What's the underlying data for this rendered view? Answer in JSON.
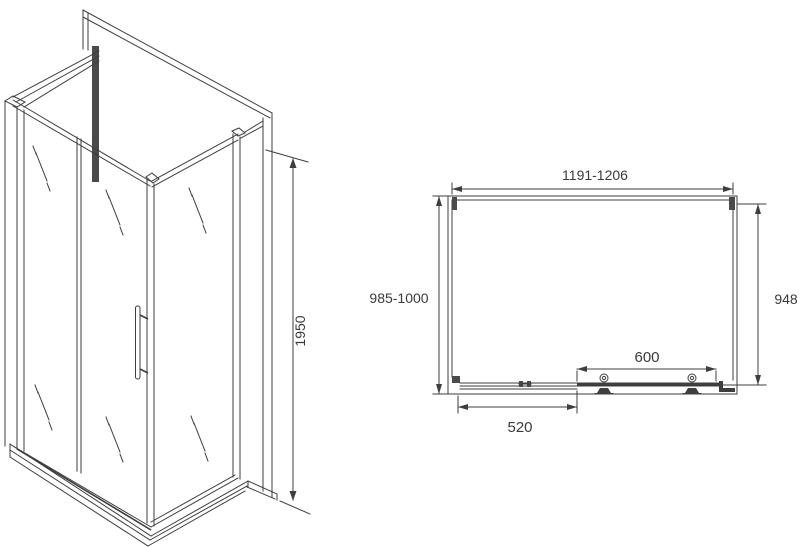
{
  "colors": {
    "line": "#3e3e3e",
    "text": "#3a3a3a",
    "background": "#ffffff"
  },
  "iso_view": {
    "height_label": "1950"
  },
  "plan_view": {
    "width_label": "1191-1206",
    "left_depth_label": "985-1000",
    "right_depth_label": "948",
    "door_width_label": "600",
    "fixed_panel_label": "520"
  }
}
